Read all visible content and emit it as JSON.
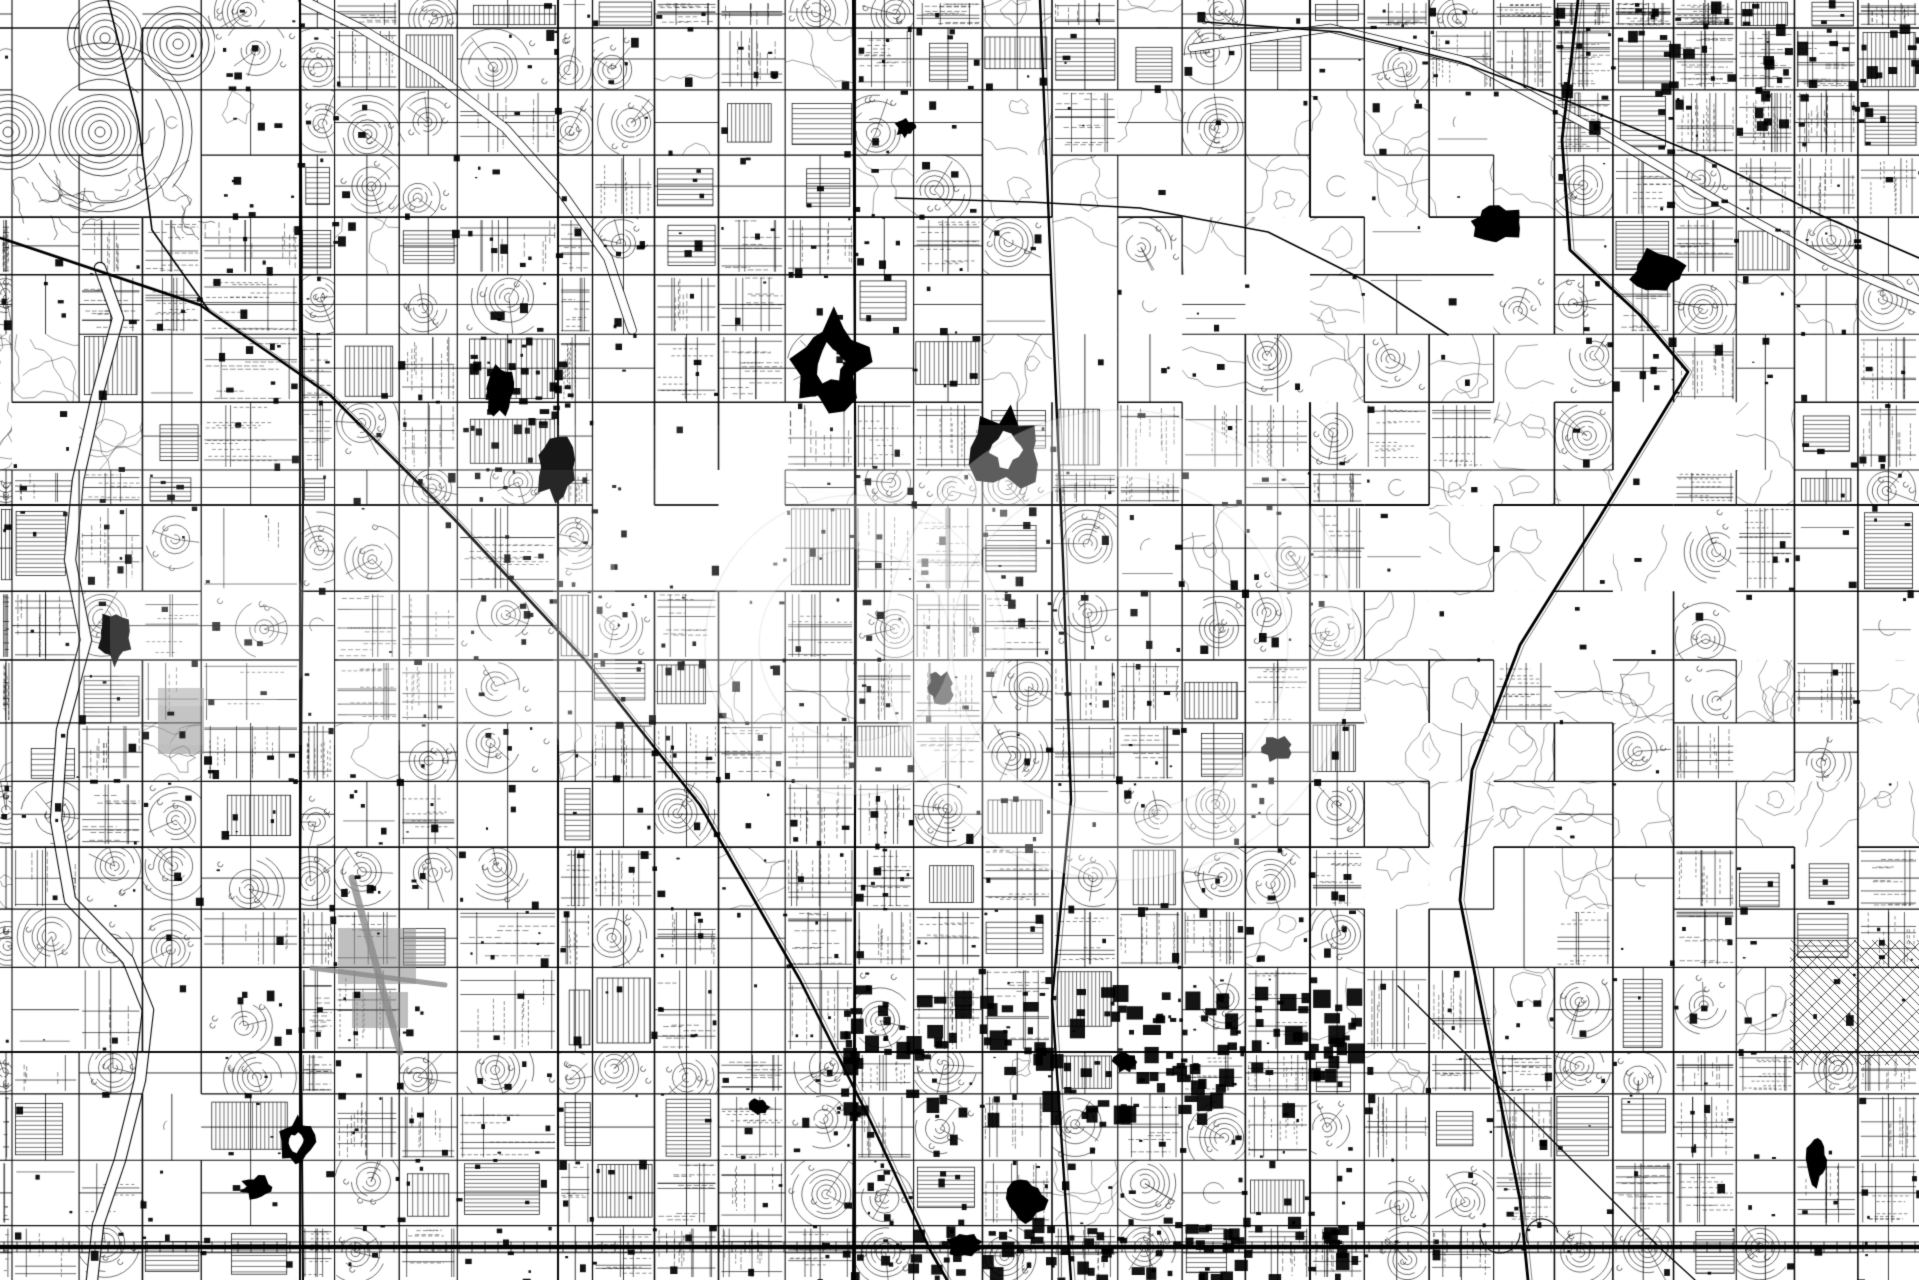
{
  "meta": {
    "width": 1919,
    "height": 1280,
    "alt": "Black and white vector street map of a large grid-planned desert city"
  },
  "map": {
    "seed": 20240613,
    "colors": {
      "bg": "#ffffff",
      "ink": "#000000",
      "gray": "#8a8a8a"
    },
    "grid": {
      "origin_x": 12,
      "origin_y": 28,
      "spacing_x": 63.9,
      "spacing_y": 63.8,
      "jitter": 6.5,
      "emphasis_x": [
        300,
        558,
        855,
        1310
      ],
      "emphasis_y": [
        505,
        1052
      ]
    },
    "collector_prob": {
      "urban": 0.5,
      "grid_fine": 0.55,
      "rural": 0.3,
      "contour": 0.12,
      "open": 0.15,
      "maze": 0.05,
      "diag_grid": 0.1
    },
    "major_skip": {
      "urban": 0,
      "grid_fine": 0,
      "rural": 0.08,
      "contour": 0.45,
      "open": 0.3,
      "maze": 0.15,
      "diag_grid": 0
    },
    "style_weights": {
      "urban": {
        "grid": 0.4,
        "loops": 0.27,
        "hatch": 0.18,
        "open": 0.09,
        "contour": 0.06
      },
      "grid_fine": {
        "grid_dense": 0.8,
        "hatch": 0.2
      },
      "contour": {
        "contour": 0.52,
        "open": 0.33,
        "loops": 0.08,
        "grid": 0.07
      },
      "rural": {
        "open": 0.42,
        "grid_sparse": 0.33,
        "loops": 0.13,
        "hatch": 0.12
      },
      "open": {
        "open": 0.85,
        "contour": 0.15
      }
    },
    "regions": [
      {
        "name": "circle-community",
        "rect": [
          0,
          0,
          215,
          240
        ],
        "style": "maze"
      },
      {
        "name": "desert-top-center",
        "rect": [
          1010,
          90,
          290,
          320
        ],
        "style": "contour"
      },
      {
        "name": "desert-top-right",
        "rect": [
          1240,
          120,
          340,
          300
        ],
        "style": "contour"
      },
      {
        "name": "desert-mid-right",
        "rect": [
          1350,
          400,
          420,
          330
        ],
        "style": "contour"
      },
      {
        "name": "desert-right-edge",
        "rect": [
          1570,
          600,
          349,
          250
        ],
        "style": "contour"
      },
      {
        "name": "desert-lower-right",
        "rect": [
          1360,
          730,
          300,
          220
        ],
        "style": "contour"
      },
      {
        "name": "wash-left-edge",
        "rect": [
          0,
          330,
          95,
          130
        ],
        "style": "contour"
      },
      {
        "name": "fields-left",
        "rect": [
          128,
          515,
          235,
          215
        ],
        "style": "rural"
      },
      {
        "name": "golf-center",
        "rect": [
          615,
          420,
          180,
          155
        ],
        "style": "open"
      },
      {
        "name": "farms-bottom-left",
        "rect": [
          0,
          945,
          225,
          335
        ],
        "style": "rural"
      },
      {
        "name": "old-town-diagonal",
        "rect": [
          1790,
          940,
          129,
          125
        ],
        "style": "diag_grid"
      },
      {
        "name": "dense-top-right",
        "rect": [
          1550,
          0,
          369,
          130
        ],
        "style": "grid_fine"
      }
    ],
    "maze": {
      "bounds": [
        0,
        0,
        215,
        240
      ],
      "ring_centers": [
        [
          105,
          38
        ],
        [
          8,
          132
        ],
        [
          100,
          132
        ],
        [
          178,
          44
        ]
      ],
      "ring_step": 6.5,
      "ring_max": 38,
      "squiggles": 16
    },
    "highways": [
      {
        "name": "railroad-diagonal",
        "width": 2.6,
        "points": [
          [
            0,
            238
          ],
          [
            200,
            305
          ],
          [
            330,
            395
          ],
          [
            455,
            520
          ],
          [
            585,
            660
          ],
          [
            700,
            805
          ],
          [
            800,
            980
          ],
          [
            870,
            1120
          ],
          [
            930,
            1250
          ],
          [
            947,
            1280
          ]
        ]
      },
      {
        "name": "north-feeder-road",
        "width": 1.6,
        "points": [
          [
            108,
            0
          ],
          [
            138,
            120
          ],
          [
            152,
            230
          ],
          [
            210,
            312
          ]
        ]
      },
      {
        "name": "arterial-west",
        "width": 2.0,
        "points": [
          [
            300,
            0
          ],
          [
            303,
            500
          ],
          [
            300,
            900
          ],
          [
            303,
            1280
          ]
        ]
      },
      {
        "name": "arterial-center",
        "width": 2.0,
        "points": [
          [
            853,
            0
          ],
          [
            856,
            600
          ],
          [
            853,
            1280
          ]
        ]
      },
      {
        "name": "freeway-center",
        "width": 2.4,
        "points": [
          [
            1040,
            0
          ],
          [
            1052,
            300
          ],
          [
            1063,
            560
          ],
          [
            1071,
            800
          ],
          [
            1052,
            1000
          ],
          [
            1071,
            1280
          ]
        ]
      },
      {
        "name": "freeway-east-loop",
        "width": 2.8,
        "points": [
          [
            1578,
            0
          ],
          [
            1562,
            140
          ],
          [
            1570,
            250
          ],
          [
            1640,
            315
          ],
          [
            1688,
            372
          ],
          [
            1598,
            520
          ],
          [
            1520,
            645
          ],
          [
            1472,
            770
          ],
          [
            1460,
            900
          ],
          [
            1492,
            1060
          ],
          [
            1520,
            1200
          ],
          [
            1528,
            1280
          ]
        ]
      },
      {
        "name": "wavy-road-top-right",
        "width": 1.7,
        "points": [
          [
            1205,
            22
          ],
          [
            1340,
            32
          ],
          [
            1460,
            62
          ],
          [
            1565,
            100
          ],
          [
            1700,
            155
          ],
          [
            1820,
            215
          ],
          [
            1919,
            258
          ]
        ]
      },
      {
        "name": "canal-road-center",
        "width": 1.5,
        "points": [
          [
            895,
            198
          ],
          [
            1030,
            202
          ],
          [
            1140,
            208
          ],
          [
            1268,
            232
          ],
          [
            1368,
            282
          ],
          [
            1448,
            335
          ]
        ]
      },
      {
        "name": "railroad-southeast",
        "width": 1.3,
        "points": [
          [
            1398,
            986
          ],
          [
            1530,
            1118
          ],
          [
            1660,
            1248
          ],
          [
            1695,
            1280
          ]
        ]
      }
    ],
    "river": {
      "name": "river-channel",
      "edge_width": 12.5,
      "fill_width": 10.2,
      "points": [
        [
          100,
          268
        ],
        [
          118,
          318
        ],
        [
          96,
          400
        ],
        [
          78,
          480
        ],
        [
          70,
          560
        ],
        [
          86,
          640
        ],
        [
          62,
          730
        ],
        [
          56,
          820
        ],
        [
          70,
          900
        ],
        [
          128,
          960
        ],
        [
          148,
          1010
        ],
        [
          140,
          1080
        ],
        [
          120,
          1160
        ],
        [
          98,
          1225
        ],
        [
          92,
          1280
        ]
      ]
    },
    "washes": [
      {
        "name": "wash-northwest",
        "edge_width": 9.6,
        "fill_width": 8.0,
        "points": [
          [
            303,
            0
          ],
          [
            360,
            28
          ],
          [
            432,
            72
          ],
          [
            505,
            128
          ],
          [
            560,
            190
          ],
          [
            608,
            258
          ],
          [
            632,
            330
          ]
        ]
      },
      {
        "name": "wash-northeast",
        "edge_width": 8.6,
        "fill_width": 7.0,
        "points": [
          [
            1192,
            48
          ],
          [
            1330,
            28
          ],
          [
            1470,
            62
          ],
          [
            1600,
            132
          ],
          [
            1725,
            205
          ],
          [
            1830,
            262
          ],
          [
            1919,
            300
          ]
        ]
      }
    ],
    "bottom_band": {
      "y": 1247,
      "x0": 0,
      "x1": 1919,
      "width": 4.4,
      "tie_step": 13,
      "tie_len": 10,
      "curl_x": 1500
    },
    "blobs": [
      [
        830,
        362,
        34,
        44,
        1
      ],
      [
        1007,
        450,
        34,
        37,
        1
      ],
      [
        556,
        468,
        20,
        30,
        0
      ],
      [
        500,
        390,
        13,
        24,
        0
      ],
      [
        1657,
        272,
        26,
        20,
        0
      ],
      [
        1497,
        222,
        25,
        17,
        0
      ],
      [
        115,
        638,
        15,
        25,
        0
      ],
      [
        296,
        1142,
        17,
        22,
        1
      ],
      [
        257,
        1187,
        14,
        11,
        0
      ],
      [
        940,
        688,
        13,
        16,
        0
      ],
      [
        1277,
        748,
        14,
        12,
        0
      ],
      [
        1817,
        1160,
        10,
        23,
        0
      ],
      [
        1026,
        1200,
        18,
        22,
        0
      ],
      [
        965,
        1245,
        17,
        11,
        0
      ],
      [
        1125,
        1062,
        11,
        9,
        0
      ],
      [
        758,
        1107,
        10,
        8,
        0
      ],
      [
        905,
        128,
        9,
        8,
        0
      ]
    ],
    "airport": {
      "runways": [
        [
          352,
          878,
          400,
          1052,
          7
        ],
        [
          312,
          968,
          445,
          985,
          5
        ]
      ],
      "aprons": [
        [
          338,
          928,
          78,
          56
        ],
        [
          352,
          992,
          56,
          36
        ],
        [
          158,
          688,
          46,
          66
        ]
      ]
    },
    "building_clusters": [
      {
        "rect": [
          840,
          985,
          520,
          130
        ],
        "count": 140,
        "min": 5,
        "max": 18
      },
      {
        "rect": [
          1550,
          0,
          369,
          125
        ],
        "count": 60,
        "min": 4,
        "max": 12
      },
      {
        "rect": [
          880,
          1215,
          460,
          60
        ],
        "count": 80,
        "min": 4,
        "max": 14
      },
      {
        "rect": [
          460,
          330,
          110,
          100
        ],
        "count": 30,
        "min": 4,
        "max": 10
      },
      {
        "rect": [
          826,
          0,
          60,
          1280
        ],
        "count": 40,
        "min": 3,
        "max": 9
      }
    ],
    "building_scatter": {
      "count": 1500,
      "min": 2,
      "max": 8
    }
  },
  "watermark": {
    "color": "#ffffff",
    "shapes": [
      {
        "type": "soft",
        "x": 60,
        "y": 425,
        "w": 1100,
        "h": 320,
        "r": 120,
        "opacity": 0.09
      },
      {
        "type": "soft",
        "x": 380,
        "y": 470,
        "w": 640,
        "h": 250,
        "r": 90,
        "opacity": 0.07
      },
      {
        "type": "ring",
        "cx": 855,
        "cy": 645,
        "ro": 150,
        "ri": 96,
        "opacity": 0.26,
        "edge_opacity": 0.1
      },
      {
        "type": "ring",
        "cx": 1120,
        "cy": 645,
        "ro": 235,
        "ri": 168,
        "opacity": 0.3,
        "edge_opacity": 0.1
      },
      {
        "type": "bar",
        "x": 553,
        "y": 545,
        "w": 62,
        "h": 205,
        "r": 26,
        "opacity": 0.25
      },
      {
        "type": "bar",
        "x": 737,
        "y": 455,
        "w": 64,
        "h": 185,
        "r": 28,
        "opacity": 0.22
      },
      {
        "type": "soft",
        "x": 110,
        "y": 556,
        "w": 200,
        "h": 150,
        "r": 60,
        "opacity": 0.16
      },
      {
        "type": "soft",
        "x": 338,
        "y": 590,
        "w": 140,
        "h": 150,
        "r": 55,
        "opacity": 0.14
      }
    ]
  }
}
